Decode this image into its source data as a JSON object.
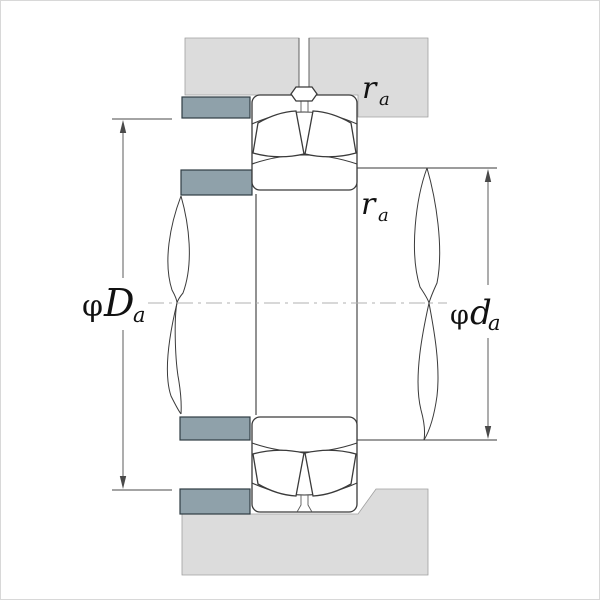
{
  "figure": {
    "type": "bearing-mounting-cross-section",
    "labels": {
      "housing_abutment": {
        "phi": "φ",
        "letter": "D",
        "sub": "a"
      },
      "shaft_abutment": {
        "phi": "φ",
        "letter": "d",
        "sub": "a"
      },
      "fillet_housing": {
        "letter": "r",
        "sub": "a"
      },
      "fillet_shaft": {
        "letter": "r",
        "sub": "a"
      }
    },
    "colors": {
      "housing": "#dcdcdc",
      "abutment": "#8fa1aa",
      "outline": "#3a3a3a",
      "dimension": "#4a4a4a",
      "centerline": "#b0b0b0",
      "background": "#ffffff"
    }
  }
}
